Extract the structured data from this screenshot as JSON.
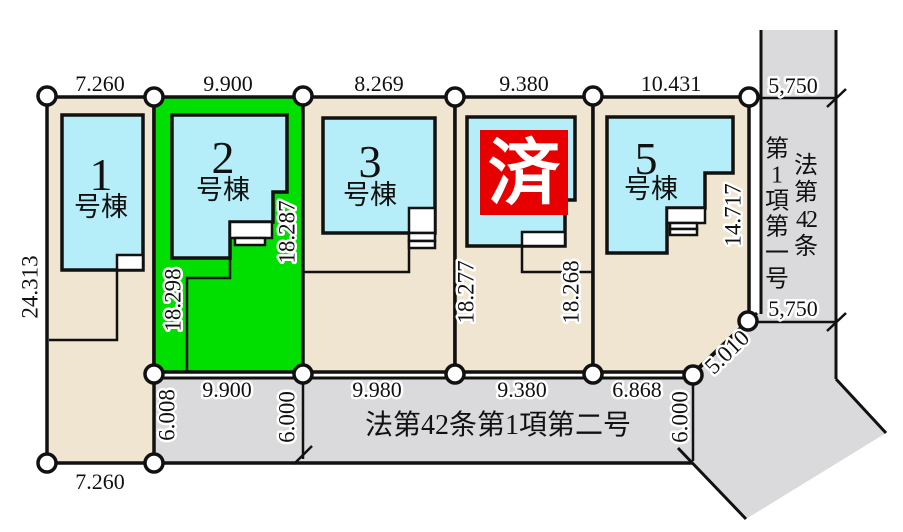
{
  "plan": {
    "lot1": {
      "num": "1",
      "suffix": "号棟",
      "dim_top": "7.260",
      "dim_left": "24.313",
      "dim_bottom": "7.260"
    },
    "lot2": {
      "num": "2",
      "suffix": "号棟",
      "dim_top": "9.900",
      "dim_left": "18.298",
      "dim_right": "18.287",
      "dim_bottom": "9.900"
    },
    "lot3": {
      "num": "3",
      "suffix": "号棟",
      "dim_top": "8.269",
      "dim_bottom": "9.980"
    },
    "lot4": {
      "sold_label": "済",
      "dim_top": "9.380",
      "dim_left": "18.277",
      "dim_right": "18.268",
      "dim_bottom": "9.380"
    },
    "lot5": {
      "num": "5",
      "suffix": "号棟",
      "dim_top": "10.431",
      "dim_right": "14.717",
      "dim_bottom": "6.868",
      "corner_dim": "5.010"
    },
    "right_road": {
      "name_col_right": "法第42条",
      "name_col_left": "第1項第一号",
      "dim_top": "5,750",
      "dim_bottom": "5,750"
    },
    "bottom_road": {
      "name": "法第42条第1項第二号",
      "dim_w_left": "6.008",
      "dim_w_mid": "6.000",
      "dim_w_right": "6.000"
    },
    "colors": {
      "lot": "#efe5d0",
      "green_lot": "#00df00",
      "building": "#b5edf8",
      "road": "#dadadc",
      "sold_red": "#e60000"
    }
  }
}
